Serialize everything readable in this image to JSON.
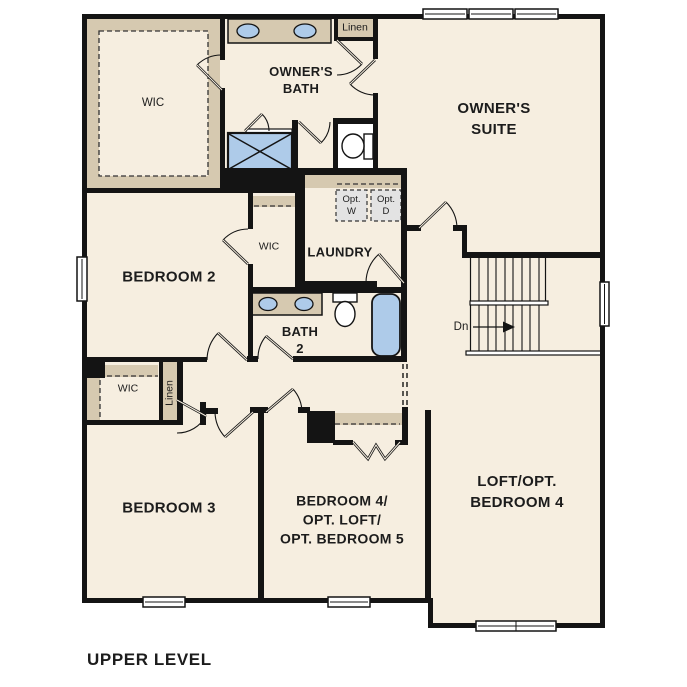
{
  "page": {
    "title": "UPPER LEVEL"
  },
  "labels": {
    "owners_wic": "WIC",
    "owners_bath": [
      "OWNER'S",
      "BATH"
    ],
    "linen_upper": "Linen",
    "owners_suite": [
      "OWNER'S",
      "SUITE"
    ],
    "opt_washer": [
      "Opt.",
      "W"
    ],
    "opt_dryer": [
      "Opt.",
      "D"
    ],
    "laundry": "LAUNDRY",
    "bedroom2": "BEDROOM 2",
    "bedroom2_wic": "WIC",
    "bath2": [
      "BATH",
      "2"
    ],
    "stairs_down": "Dn",
    "bedroom3_wic": "WIC",
    "bedroom3_linen": "Linen",
    "bedroom3": "BEDROOM 3",
    "bedroom4": [
      "BEDROOM 4/",
      "OPT. LOFT/",
      "OPT. BEDROOM 5"
    ],
    "loft": [
      "LOFT/OPT.",
      "BEDROOM 4"
    ],
    "level_title": "UPPER LEVEL"
  },
  "colors": {
    "background": "#ffffff",
    "floor": "#f6eee0",
    "wall": "#141414",
    "cabinet_tan": "#d6c9b0",
    "fixture_blue": "#aecbe9",
    "optional_gray": "#e3e3e3",
    "window_white": "#ffffff",
    "text": "#1c1c1c"
  }
}
